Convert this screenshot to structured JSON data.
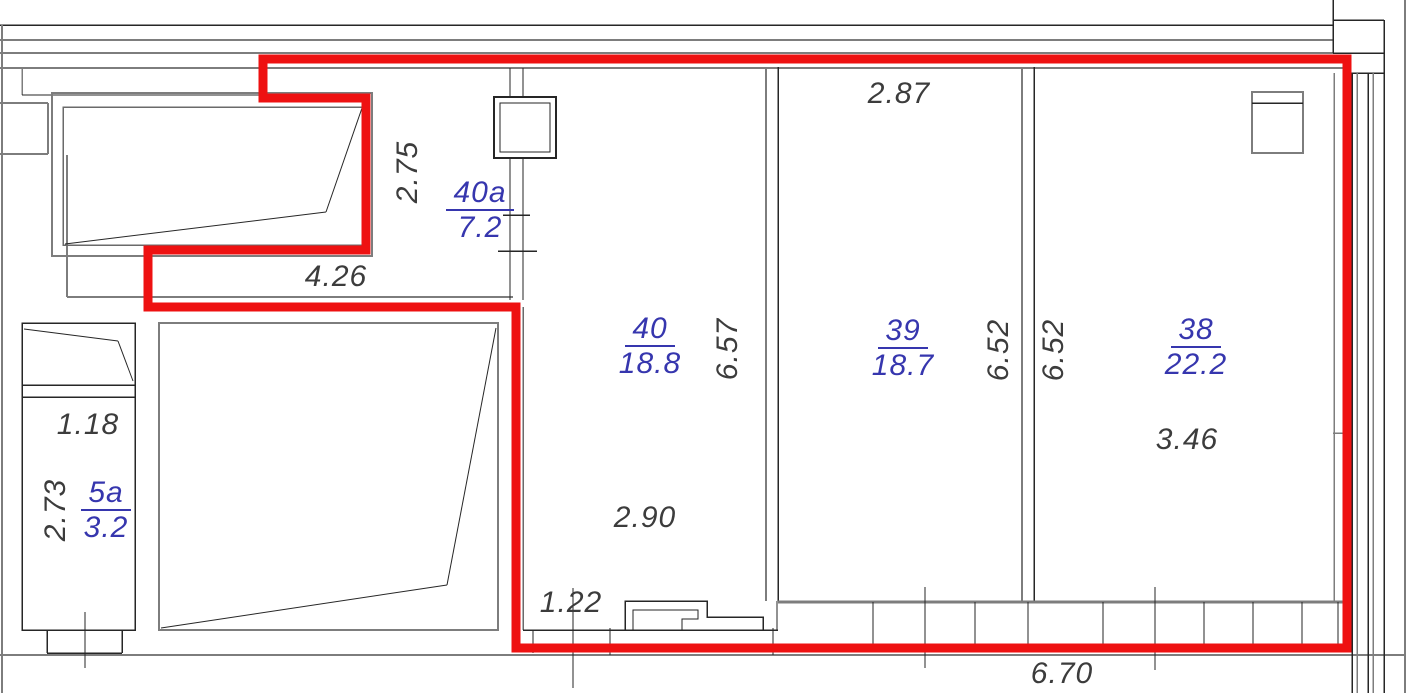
{
  "plan_title": "apartment-floor-plan",
  "rooms": [
    {
      "number": "40a",
      "area": "7.2"
    },
    {
      "number": "40",
      "area": "18.8"
    },
    {
      "number": "39",
      "area": "18.7"
    },
    {
      "number": "38",
      "area": "22.2"
    },
    {
      "number": "5a",
      "area": "3.2"
    }
  ],
  "dimensions": {
    "d2_75": "2.75",
    "d4_26": "4.26",
    "d2_87": "2.87",
    "d6_57": "6.57",
    "d6_52_a": "6.52",
    "d6_52_b": "6.52",
    "d3_46": "3.46",
    "d2_90": "2.90",
    "d1_22": "1.22",
    "d1_18": "1.18",
    "d2_73": "2.73",
    "d6_70": "6.70"
  },
  "colors": {
    "unit_outline": "#ee1111",
    "room_label": "#3636ae",
    "dimension_text": "#3c3c3c",
    "wall_gray": "#7d7d7d",
    "wall_dark": "#262626"
  }
}
